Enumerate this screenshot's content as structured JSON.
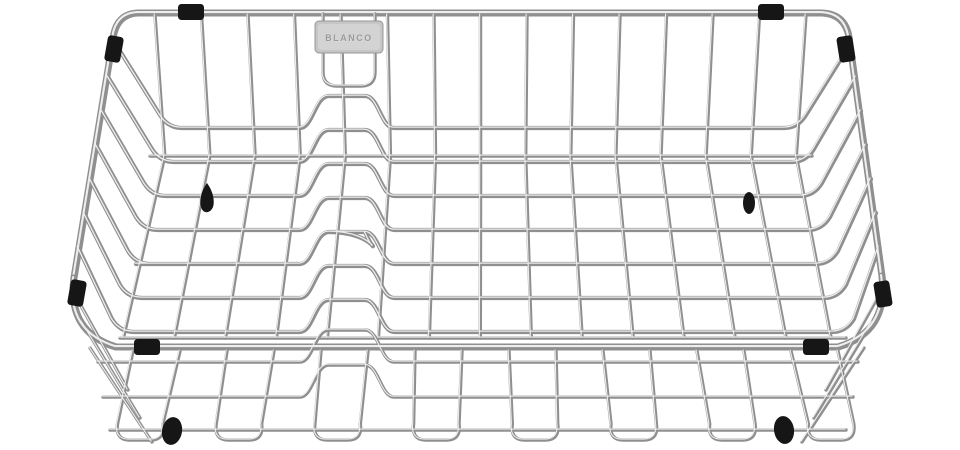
{
  "image": {
    "type": "product-photo",
    "subject": "chrome wire dish drainer crockery basket",
    "background_color": "#ffffff"
  },
  "badge": {
    "brand_label": "BLANCO"
  },
  "colors": {
    "wire_base": "#8f8f8f",
    "wire_highlight": "#eeeeee",
    "black_accents": "#161616",
    "badge_plate": "#c6c6c6"
  },
  "parts": {
    "corner_clips": 8,
    "rubber_feet": 2,
    "mounting_knobs": 2,
    "plate_rack_rows": 9,
    "back_wall_wires": 15,
    "front_wall_loops": 8
  }
}
